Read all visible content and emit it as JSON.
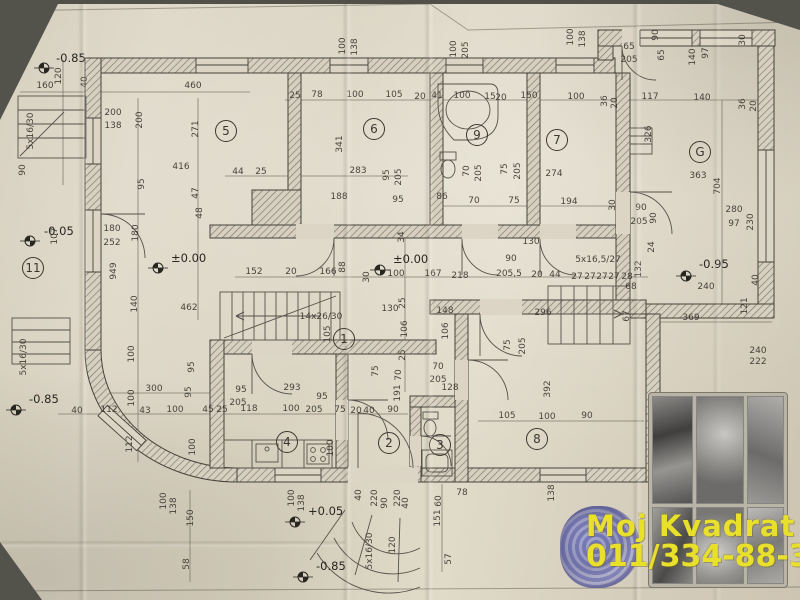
{
  "watermark": {
    "line1": "Moj Kvadrat",
    "line2": "011/334-88-36",
    "color": "#e9e02c"
  },
  "plan": {
    "rooms": [
      [
        "5",
        226,
        131
      ],
      [
        "6",
        374,
        129
      ],
      [
        "9",
        477,
        135
      ],
      [
        "7",
        557,
        140
      ],
      [
        "G",
        700,
        152
      ],
      [
        "11",
        33,
        268
      ],
      [
        "1",
        344,
        339
      ],
      [
        "4",
        287,
        442
      ],
      [
        "2",
        389,
        443
      ],
      [
        "3",
        440,
        445
      ],
      [
        "8",
        537,
        439
      ]
    ],
    "elevation_markers": [
      [
        "-0.85",
        44,
        68,
        56,
        62
      ],
      [
        "-0.05",
        30,
        241,
        44,
        235
      ],
      [
        "±0.00",
        158,
        268,
        171,
        262
      ],
      [
        "±0.00",
        380,
        270,
        393,
        263
      ],
      [
        "-0.95",
        686,
        276,
        699,
        268
      ],
      [
        "+0.05",
        295,
        522,
        308,
        515
      ],
      [
        "-0.85",
        303,
        577,
        316,
        570
      ],
      [
        "-0.85",
        16,
        410,
        29,
        403
      ]
    ],
    "labels": [
      [
        "160",
        45,
        88
      ],
      [
        "120",
        61,
        76,
        -90
      ],
      [
        "40",
        87,
        82,
        -90
      ],
      [
        "460",
        193,
        88
      ],
      [
        "200",
        113,
        115
      ],
      [
        "138",
        113,
        128
      ],
      [
        "200",
        142,
        120,
        -90
      ],
      [
        "271",
        198,
        129,
        -90
      ],
      [
        "5x16/30",
        33,
        131,
        -90
      ],
      [
        "90",
        25,
        170,
        -90
      ],
      [
        "25",
        295,
        98
      ],
      [
        "78",
        317,
        97
      ],
      [
        "100",
        355,
        97
      ],
      [
        "105",
        394,
        97
      ],
      [
        "20",
        420,
        99
      ],
      [
        "41",
        437,
        98
      ],
      [
        "100",
        462,
        98
      ],
      [
        "15",
        490,
        99
      ],
      [
        "20",
        501,
        100
      ],
      [
        "150",
        529,
        98
      ],
      [
        "100",
        345,
        46,
        -90
      ],
      [
        "138",
        357,
        47,
        -90
      ],
      [
        "100",
        456,
        49,
        -90
      ],
      [
        "205",
        468,
        50,
        -90
      ],
      [
        "341",
        342,
        144,
        -90
      ],
      [
        "100",
        573,
        37,
        -90
      ],
      [
        "138",
        585,
        39,
        -90
      ],
      [
        "65",
        629,
        49
      ],
      [
        "205",
        629,
        62
      ],
      [
        "90",
        658,
        35,
        -90
      ],
      [
        "65",
        664,
        55,
        -90
      ],
      [
        "140",
        695,
        57,
        -90
      ],
      [
        "97",
        708,
        53,
        -90
      ],
      [
        "30",
        745,
        40,
        -90
      ],
      [
        "100",
        576,
        99
      ],
      [
        "36",
        607,
        101,
        -90
      ],
      [
        "20",
        617,
        103,
        -90
      ],
      [
        "117",
        650,
        99
      ],
      [
        "140",
        702,
        100
      ],
      [
        "36",
        745,
        104,
        -90
      ],
      [
        "20",
        756,
        106,
        -90
      ],
      [
        "326",
        651,
        134,
        -90
      ],
      [
        "363",
        698,
        178
      ],
      [
        "704",
        720,
        186,
        -90
      ],
      [
        "90",
        641,
        210
      ],
      [
        "205",
        639,
        224
      ],
      [
        "90",
        656,
        218,
        -90
      ],
      [
        "24",
        654,
        247,
        -90
      ],
      [
        "280",
        734,
        212
      ],
      [
        "97",
        734,
        226
      ],
      [
        "230",
        753,
        222,
        -90
      ],
      [
        "240",
        706,
        289
      ],
      [
        "68",
        631,
        289
      ],
      [
        "132",
        641,
        269,
        -90
      ],
      [
        "67",
        629,
        316,
        -90
      ],
      [
        "121",
        747,
        306,
        -90
      ],
      [
        "40",
        758,
        280,
        -90
      ],
      [
        "369",
        691,
        320
      ],
      [
        "240",
        758,
        353
      ],
      [
        "222",
        758,
        364
      ],
      [
        "416",
        181,
        169
      ],
      [
        "95",
        144,
        184,
        -90
      ],
      [
        "47",
        198,
        193,
        -90
      ],
      [
        "48",
        202,
        213,
        -90
      ],
      [
        "107",
        57,
        236,
        -90
      ],
      [
        "180",
        112,
        231
      ],
      [
        "252",
        112,
        245
      ],
      [
        "180",
        138,
        233,
        -90
      ],
      [
        "949",
        116,
        271,
        -90
      ],
      [
        "140",
        137,
        304,
        -90
      ],
      [
        "462",
        189,
        310
      ],
      [
        "44",
        238,
        174
      ],
      [
        "25",
        261,
        174
      ],
      [
        "283",
        358,
        173
      ],
      [
        "95",
        389,
        175,
        -90
      ],
      [
        "205",
        401,
        177,
        -90
      ],
      [
        "188",
        339,
        199
      ],
      [
        "95",
        398,
        202
      ],
      [
        "34",
        404,
        237,
        -90
      ],
      [
        "152",
        254,
        274
      ],
      [
        "20",
        291,
        274
      ],
      [
        "166",
        328,
        274
      ],
      [
        "88",
        345,
        267,
        -90
      ],
      [
        "30",
        369,
        277,
        -90
      ],
      [
        "100",
        396,
        276
      ],
      [
        "167",
        433,
        276
      ],
      [
        "130",
        390,
        311
      ],
      [
        "25",
        405,
        303,
        -90
      ],
      [
        "106",
        407,
        329,
        -90
      ],
      [
        "25",
        405,
        355,
        -90
      ],
      [
        "70",
        401,
        375,
        -90
      ],
      [
        "14x26/30",
        321,
        319
      ],
      [
        "105",
        330,
        334,
        -90
      ],
      [
        "70",
        469,
        171,
        -90
      ],
      [
        "205",
        481,
        173,
        -90
      ],
      [
        "75",
        507,
        169,
        -90
      ],
      [
        "205",
        520,
        171,
        -90
      ],
      [
        "274",
        554,
        176
      ],
      [
        "86",
        442,
        199
      ],
      [
        "70",
        474,
        203
      ],
      [
        "75",
        514,
        203
      ],
      [
        "194",
        569,
        204
      ],
      [
        "30",
        615,
        205,
        -90
      ],
      [
        "90",
        511,
        261
      ],
      [
        "205,5",
        509,
        276
      ],
      [
        "5x16,5/27",
        598,
        262
      ],
      [
        "218",
        460,
        278
      ],
      [
        "20",
        537,
        277
      ],
      [
        "44",
        555,
        277
      ],
      [
        "27",
        577,
        279
      ],
      [
        "27",
        590,
        279
      ],
      [
        "27",
        602,
        279
      ],
      [
        "27",
        614,
        279
      ],
      [
        "28",
        627,
        279
      ],
      [
        "130",
        531,
        244
      ],
      [
        "148",
        445,
        313
      ],
      [
        "296",
        543,
        315
      ],
      [
        "106",
        448,
        331,
        -90
      ],
      [
        "128",
        450,
        390
      ],
      [
        "70",
        438,
        369
      ],
      [
        "205",
        438,
        382
      ],
      [
        "75",
        510,
        345,
        -90
      ],
      [
        "205",
        525,
        346,
        -90
      ],
      [
        "392",
        550,
        389,
        -90
      ],
      [
        "105",
        507,
        418
      ],
      [
        "100",
        547,
        419
      ],
      [
        "90",
        587,
        418
      ],
      [
        "191",
        400,
        393,
        -90
      ],
      [
        "5x16/30",
        26,
        357,
        -90
      ],
      [
        "300",
        154,
        391
      ],
      [
        "40",
        77,
        413
      ],
      [
        "112",
        109,
        412
      ],
      [
        "43",
        145,
        413
      ],
      [
        "100",
        175,
        412
      ],
      [
        "45",
        208,
        412
      ],
      [
        "100",
        134,
        354,
        -90
      ],
      [
        "100",
        134,
        398,
        -90
      ],
      [
        "112",
        132,
        444,
        -90
      ],
      [
        "95",
        194,
        367,
        -90
      ],
      [
        "95",
        191,
        392,
        -90
      ],
      [
        "100",
        195,
        447,
        -90
      ],
      [
        "25",
        222,
        412
      ],
      [
        "118",
        249,
        411
      ],
      [
        "100",
        291,
        411
      ],
      [
        "205",
        314,
        412
      ],
      [
        "75",
        340,
        412
      ],
      [
        "20",
        356,
        413
      ],
      [
        "40",
        369,
        413
      ],
      [
        "90",
        393,
        412
      ],
      [
        "95",
        241,
        392
      ],
      [
        "205",
        238,
        405
      ],
      [
        "293",
        292,
        390
      ],
      [
        "95",
        322,
        399
      ],
      [
        "75",
        378,
        371,
        -90
      ],
      [
        "100",
        333,
        448,
        -90
      ],
      [
        "100",
        294,
        498,
        -90
      ],
      [
        "138",
        304,
        503,
        -90
      ],
      [
        "40",
        361,
        495,
        -90
      ],
      [
        "220",
        377,
        498,
        -90
      ],
      [
        "90",
        387,
        503,
        -90
      ],
      [
        "220",
        400,
        498,
        -90
      ],
      [
        "40",
        408,
        503,
        -90
      ],
      [
        "60",
        441,
        501,
        -90
      ],
      [
        "151",
        440,
        518,
        -90
      ],
      [
        "78",
        462,
        495
      ],
      [
        "57",
        451,
        559,
        -90
      ],
      [
        "5x16/30",
        372,
        551,
        -90
      ],
      [
        "120",
        395,
        545,
        -90
      ],
      [
        "100",
        166,
        501,
        -90
      ],
      [
        "138",
        176,
        506,
        -90
      ],
      [
        "150",
        193,
        518,
        -90
      ],
      [
        "58",
        189,
        564,
        -90
      ],
      [
        "138",
        554,
        493,
        -90
      ]
    ]
  }
}
